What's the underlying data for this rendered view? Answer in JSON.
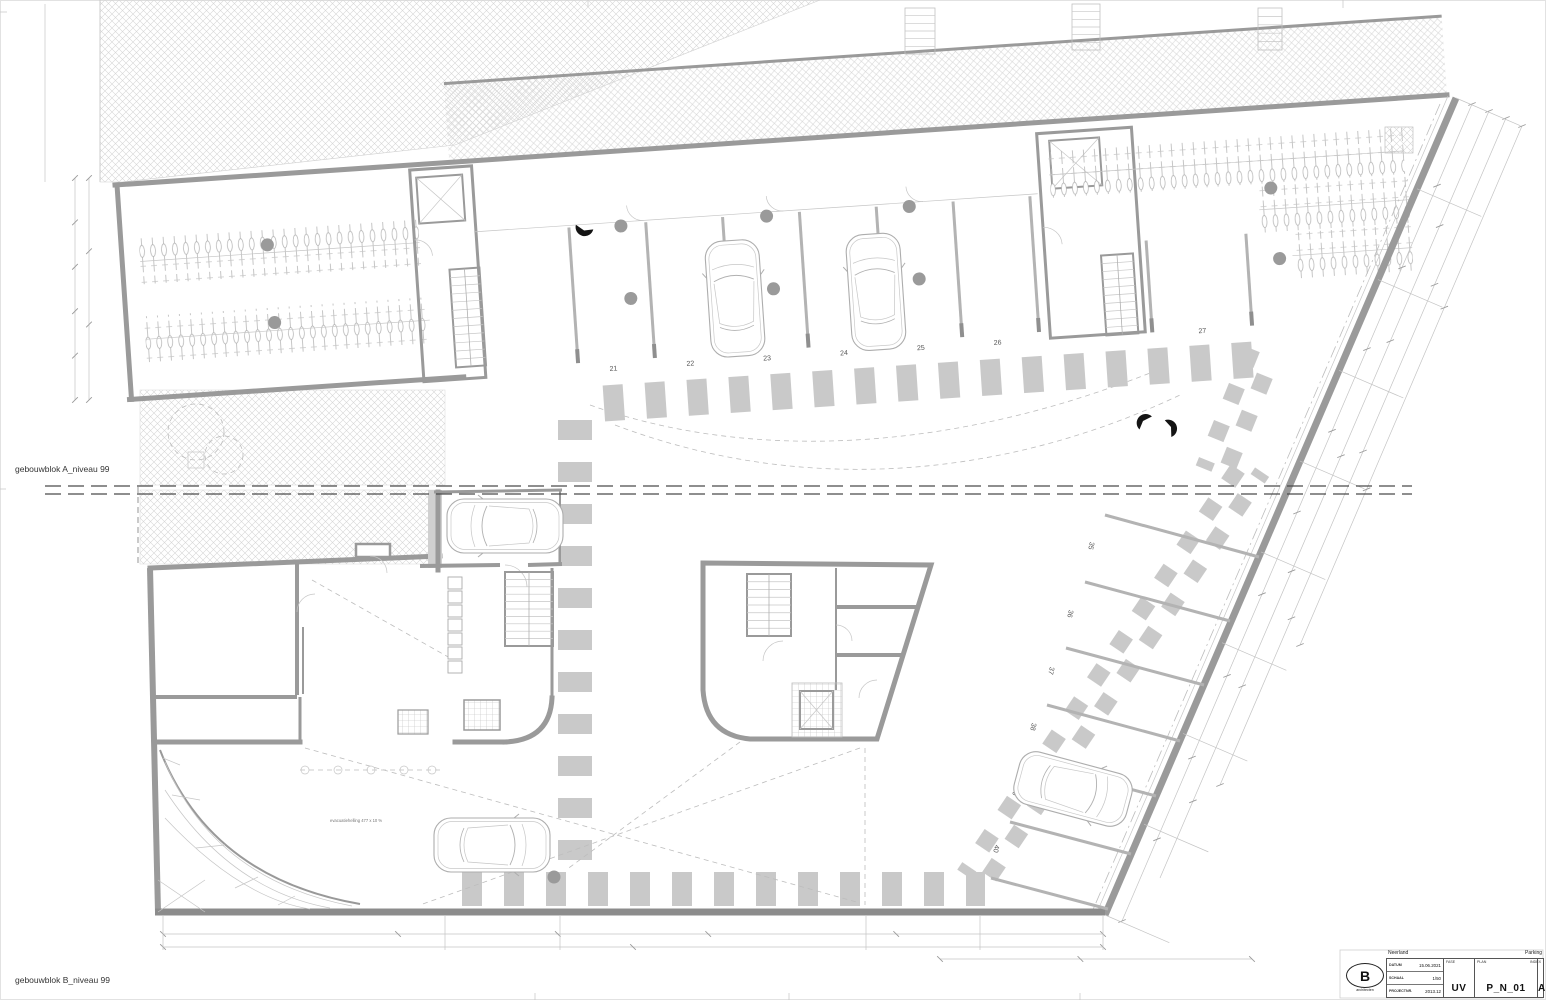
{
  "labels": {
    "block_a": "gebouwblok A_niveau 99",
    "block_b": "gebouwblok B_niveau 99",
    "ramp_note": "evacuatiehelling 477 x 10 %"
  },
  "parking": {
    "block_a_stalls": [
      "21",
      "22",
      "23",
      "24",
      "25",
      "26",
      "27"
    ],
    "block_b_stalls": [
      "35",
      "36",
      "37",
      "38",
      "39",
      "40"
    ]
  },
  "title_block": {
    "project": "Neerland",
    "sheet": "Parking",
    "logo_letter": "B",
    "logo_sub": "architecten",
    "datum_label": "DATUM",
    "datum": "15.06.2021",
    "schaal_label": "SCHAAL",
    "schaal": "1/50",
    "projectnr_label": "PROJECTNR.",
    "projectnr": "2013.12",
    "fase_label": "FASE",
    "fase": "UV",
    "plan_label": "PLAN",
    "plan": "P_N_01",
    "index_label": "INDEX",
    "index": "A"
  },
  "colors": {
    "wall": "#9a9a9a",
    "stripe": "#c9c9c9",
    "hatch_line": "#d6d6d6",
    "thin_line": "#c2c2c2",
    "column": "#9a9a9a",
    "match_line": "#4a4a4a",
    "text": "#444444"
  }
}
